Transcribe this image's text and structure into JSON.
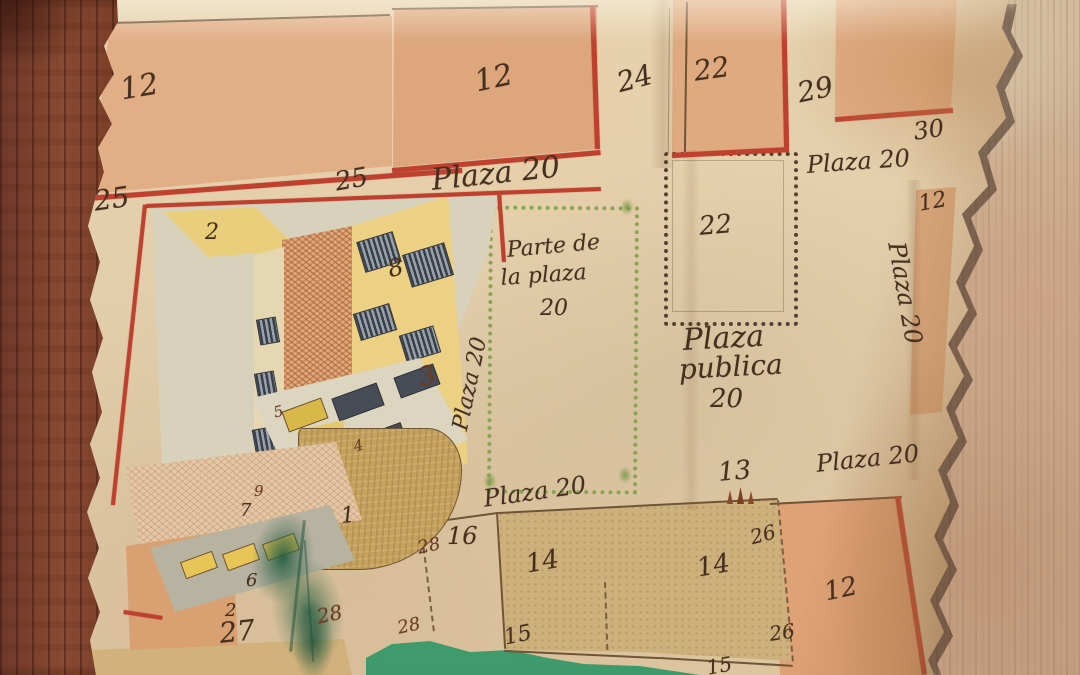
{
  "map": {
    "kind": "historical hand-drawn town plan on torn parchment, photographed on wood",
    "labels": {
      "plot12_topleft": "12",
      "plot25_left": "25",
      "plot25_mid": "25",
      "plot12_topcenter": "12",
      "street24": "24",
      "plot22_top": "22",
      "street29": "29",
      "plot30": "30",
      "plaza20_topright": "Plaza 20",
      "plot12_rightstrip": "12",
      "plaza20_right_vertical": "Plaza 20",
      "plaza20_main": "Plaza 20",
      "plot2_courtyard": "2",
      "plot8": "8",
      "plot3": "3",
      "plot5": "5",
      "plot4": "4",
      "plot9": "9",
      "plot7": "7",
      "plot1": "1",
      "plot6": "6",
      "plot2_small": "2",
      "plot27": "27",
      "plot28_a": "28",
      "plot28_b": "28",
      "plot28_c": "28",
      "plot16": "16",
      "plaza20_bottom": "Plaza 20",
      "plot13": "13",
      "plot14_a": "14",
      "plot14_b": "14",
      "plot26_a": "26",
      "plot26_b": "26",
      "plot15_a": "15",
      "plot15_b": "15",
      "plaza20_bottomright": "Plaza 20",
      "plot12_bottomright": "12",
      "plot22_center": "22",
      "plaza_publica_line1": "Plaza",
      "plaza_publica_line2": "publica",
      "plaza_publica_line3": "20",
      "parte_line1": "Parte de",
      "parte_line2": "la plaza",
      "parte_line3": "20",
      "plaza20_left_vertical": "Plaza 20"
    },
    "palette": {
      "red_line": "#c0402f",
      "parchment": "#e2cdaa",
      "salmon_block": "#e3ab82",
      "tan_plot": "#d0b483",
      "pond_green": "#4fae7c",
      "plaza_border_green": "#8aa455",
      "ink": "#45301f",
      "wood_dark": "#7c4434",
      "wood_light": "#c7ab8f",
      "building_yellow": "#ecd083"
    }
  }
}
